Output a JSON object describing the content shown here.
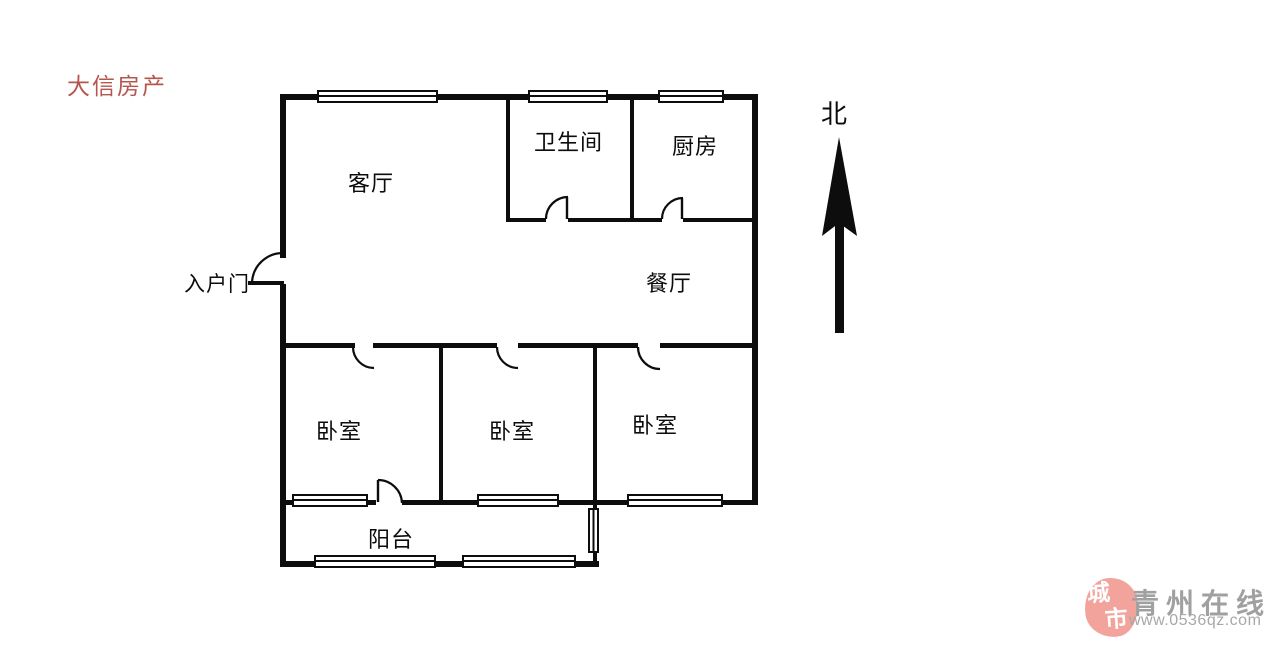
{
  "watermark": {
    "text": "大信房产",
    "color": "#b6554d"
  },
  "compass": {
    "label": "北"
  },
  "rooms": {
    "living": "客厅",
    "bathroom": "卫生间",
    "kitchen": "厨房",
    "dining": "餐厅",
    "entrance": "入户门",
    "bedroom1": "卧室",
    "bedroom2": "卧室",
    "bedroom3": "卧室",
    "balcony": "阳台"
  },
  "branding": {
    "seal_top": "城",
    "seal_bottom": "市",
    "site_name": "青州在线",
    "site_url": "www.0536qz.com",
    "seal_color": "#f1a39c",
    "text_color": "#a0a0a0"
  },
  "colors": {
    "wall": "#0d0d0d",
    "background": "#ffffff"
  }
}
